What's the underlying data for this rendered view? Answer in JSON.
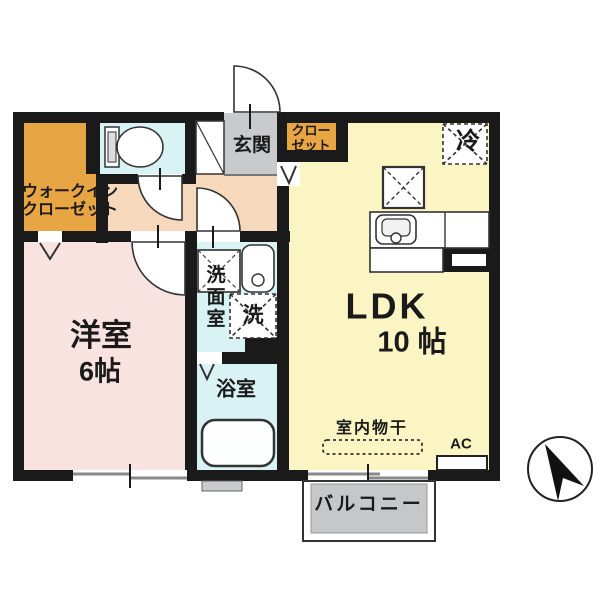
{
  "plan": {
    "type": "apartment-floor-plan",
    "labels": {
      "wic_line1": "ウォークイン",
      "wic_line2": "クローゼット",
      "genkan": "玄関",
      "closet_line1": "クロー",
      "closet_line2": "ゼット",
      "fridge": "冷",
      "ldk_name": "LDK",
      "ldk_size": "10 帖",
      "bedroom_name": "洋室",
      "bedroom_size": "6帖",
      "washroom_c1": "洗",
      "washroom_c2": "面",
      "washroom_c3": "室",
      "washer": "洗",
      "bath": "浴室",
      "indoor_drying": "室内物干",
      "ac": "AC",
      "balcony": "バルコニー"
    },
    "colors": {
      "wall": "#1a1a1a",
      "wic_orange": "#e8a544",
      "closet_orange": "#e8a544",
      "wet_room_cyan": "#d9f3f5",
      "corridor_peach": "#f6d9bc",
      "bedroom_pink": "#f9e3e1",
      "ldk_yellow": "#faf5c3",
      "entrance_gray": "#c8cacc",
      "balcony_gray": "#c5c7c9"
    }
  }
}
